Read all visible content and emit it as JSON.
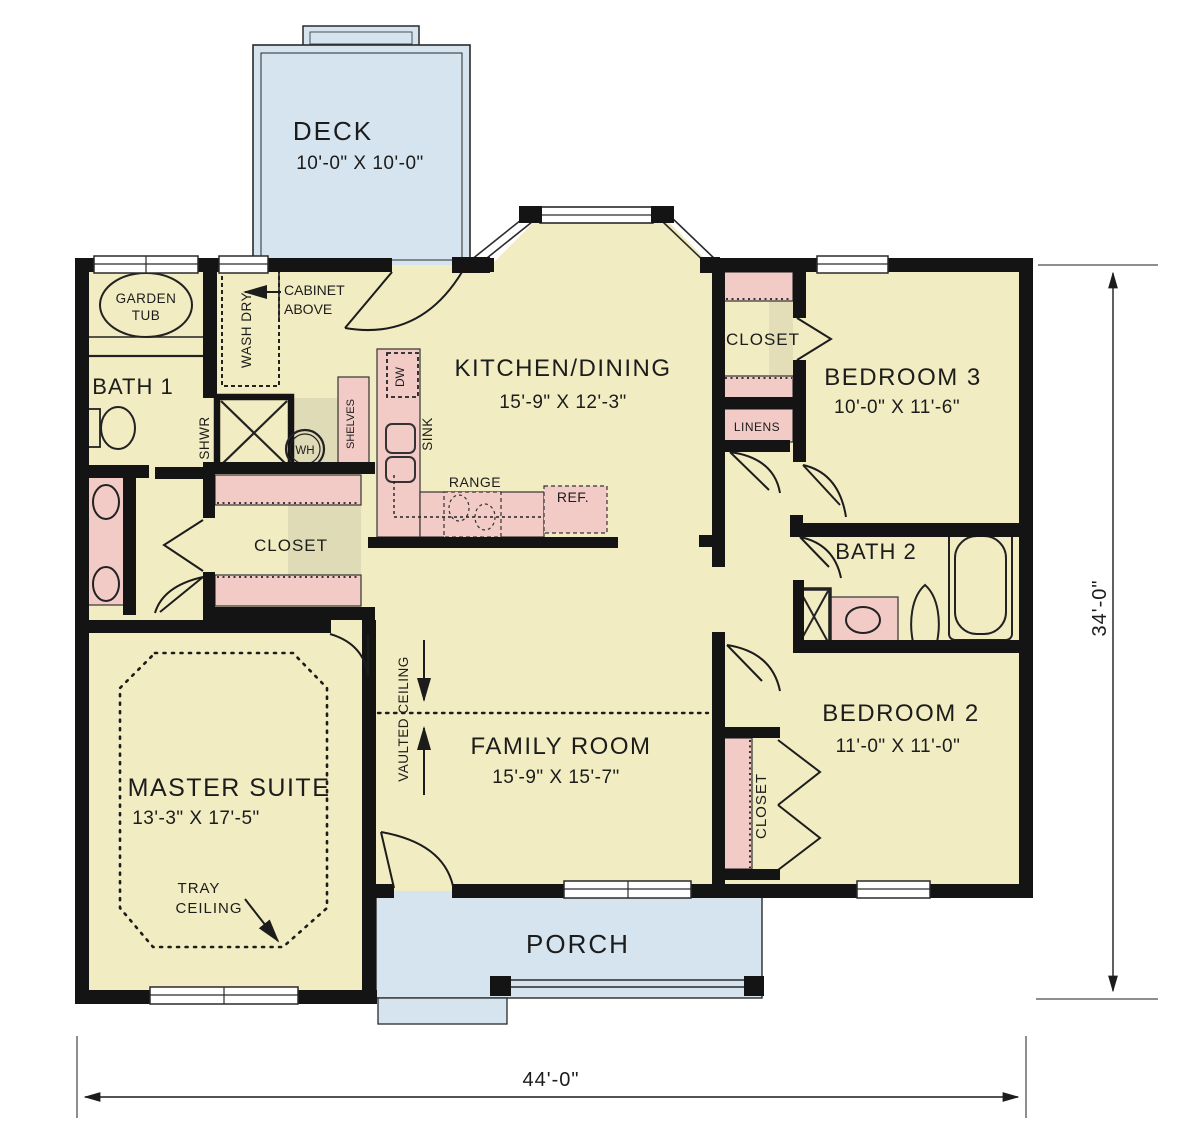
{
  "page": {
    "title": "House Floor Plan"
  },
  "colors": {
    "floor": "#f1ecc2",
    "fixture_pink": "#f2cbc7",
    "outdoor_blue": "#d5e4ee",
    "wall": "#141414",
    "text": "#1c1c1c",
    "shadow": "#d2cdae"
  },
  "rooms": {
    "deck": {
      "name": "DECK",
      "dims": "10'-0\" X 10'-0\""
    },
    "kitchen": {
      "name": "KITCHEN/DINING",
      "dims": "15'-9\" X 12'-3\""
    },
    "bedroom3": {
      "name": "BEDROOM 3",
      "dims": "10'-0\" X 11'-6\""
    },
    "bath1": {
      "name": "BATH 1"
    },
    "bath2": {
      "name": "BATH 2"
    },
    "bedroom2": {
      "name": "BEDROOM 2",
      "dims": "11'-0\" X  11'-0\""
    },
    "family": {
      "name": "FAMILY ROOM",
      "dims": "15'-9\" X 15'-7\""
    },
    "master": {
      "name": "MASTER SUITE",
      "dims": "13'-3\" X 17'-5\""
    },
    "porch": {
      "name": "PORCH"
    }
  },
  "features": {
    "closet_hall": "CLOSET",
    "closet_bedroom3": "CLOSET",
    "closet_bedroom2": "CLOSET",
    "linens": "LINENS",
    "garden_tub_line1": "GARDEN",
    "garden_tub_line2": "TUB",
    "shower": "SHWR",
    "water_heater": "WH",
    "shelves": "SHELVES",
    "washer_dryer": "WASH  DRY",
    "cabinet_line1": "CABINET",
    "cabinet_line2": "ABOVE",
    "dishwasher": "DW",
    "sink": "SINK",
    "range": "RANGE",
    "refrigerator": "REF.",
    "vaulted_ceiling": "VAULTED CEILING",
    "tray_ceiling_line1": "TRAY",
    "tray_ceiling_line2": "CEILING"
  },
  "dimensions": {
    "overall_width": "44'-0\"",
    "overall_depth": "34'-0\""
  }
}
